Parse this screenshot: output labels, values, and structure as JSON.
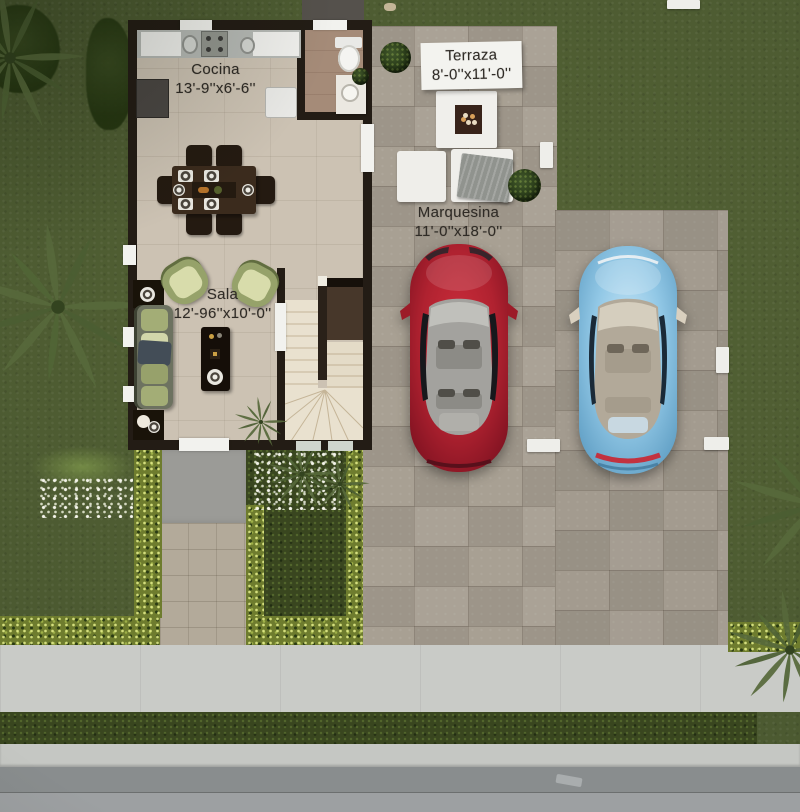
{
  "scene": {
    "type": "3d-rendered-floor-plan",
    "rooms": {
      "cocina": {
        "name": "Cocina",
        "dimensions": "13'-9''x6'-6''"
      },
      "terraza": {
        "name": "Terraza",
        "dimensions": "8'-0''x11'-0''"
      },
      "marquesina": {
        "name": "Marquesina",
        "dimensions": "11'-0''x18'-0''"
      },
      "sala": {
        "name": "Sala",
        "dimensions": "12'-96''x10'-0''"
      }
    },
    "objects": {
      "cars": [
        {
          "name": "red-car",
          "color": "#b02230"
        },
        {
          "name": "blue-car",
          "color": "#92c8e6"
        }
      ],
      "dining_chairs": 6,
      "armchairs": 2,
      "terrace_ottomans": 2,
      "fire_table": 1,
      "palm_trees": 4
    },
    "colors": {
      "grass": "#4c5a31",
      "hedge": "#6e7c2e",
      "pavers": "#a59d90",
      "interior_floor": "#ccc2b3",
      "wall": "#231c15",
      "stairs": "#e9e1cf",
      "sidewalk": "#c9cbc7",
      "street": "#898d8e",
      "label_text": "#2f2b26"
    }
  }
}
